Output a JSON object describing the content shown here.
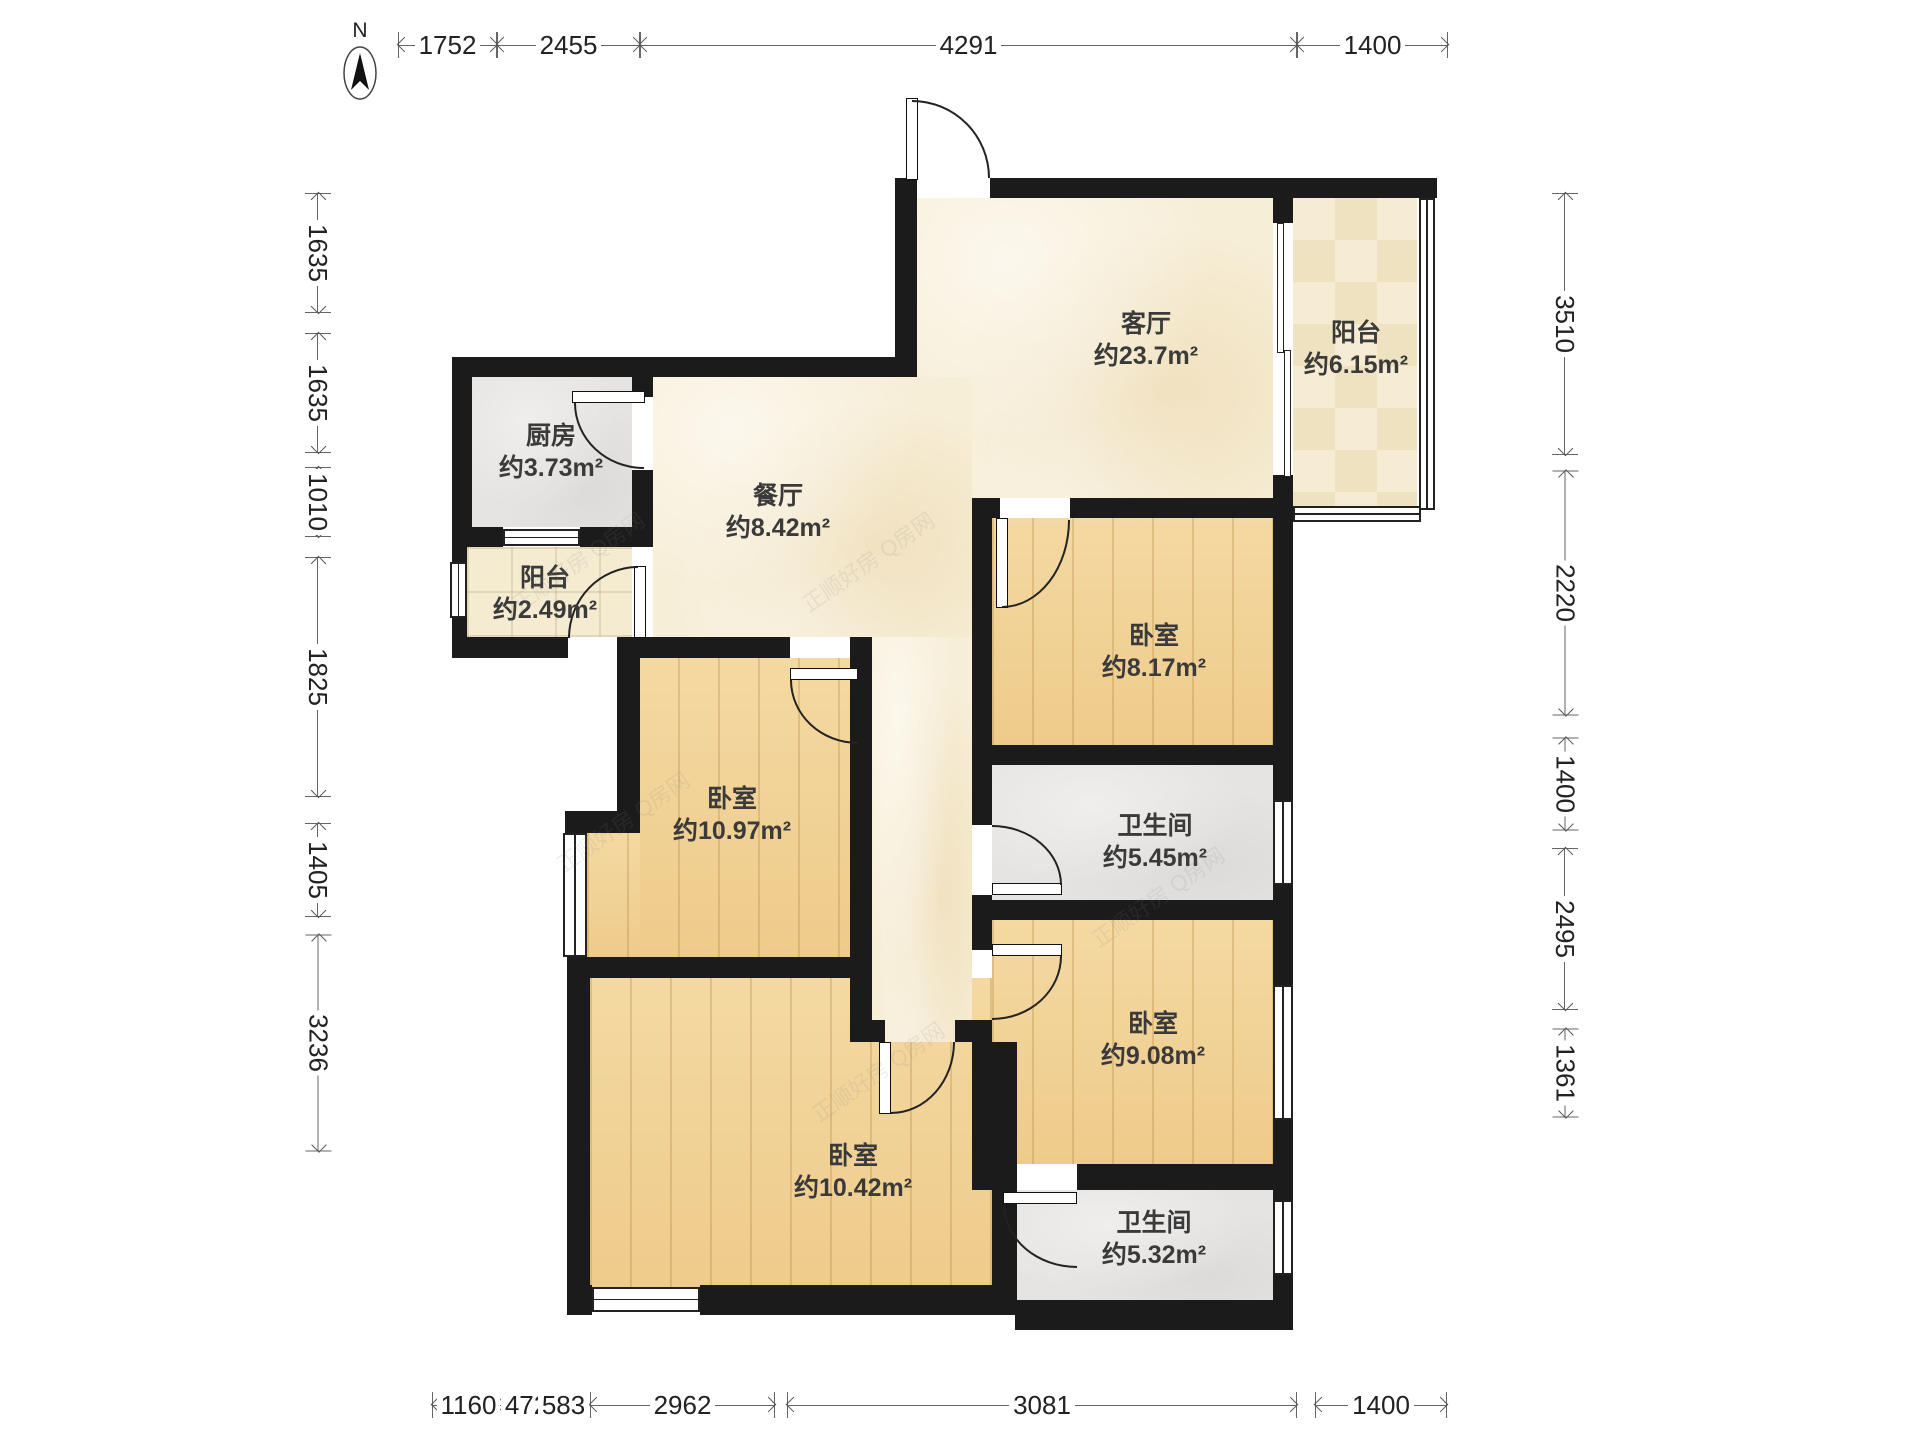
{
  "north": {
    "label": "N"
  },
  "watermark": {
    "text": "正顺好房 Q房网"
  },
  "rooms": [
    {
      "id": "living",
      "name": "客厅",
      "area": "约23.7m²"
    },
    {
      "id": "balcony-right",
      "name": "阳台",
      "area": "约6.15m²"
    },
    {
      "id": "kitchen",
      "name": "厨房",
      "area": "约3.73m²"
    },
    {
      "id": "dining",
      "name": "餐厅",
      "area": "约8.42m²"
    },
    {
      "id": "balcony-left",
      "name": "阳台",
      "area": "约2.49m²"
    },
    {
      "id": "bedroom-ne",
      "name": "卧室",
      "area": "约8.17m²"
    },
    {
      "id": "bedroom-west",
      "name": "卧室",
      "area": "约10.97m²"
    },
    {
      "id": "bathroom-mid",
      "name": "卫生间",
      "area": "约5.45m²"
    },
    {
      "id": "bedroom-east",
      "name": "卧室",
      "area": "约9.08m²"
    },
    {
      "id": "bedroom-south",
      "name": "卧室",
      "area": "约10.42m²"
    },
    {
      "id": "bathroom-south",
      "name": "卫生间",
      "area": "约5.32m²"
    }
  ],
  "dimensions": {
    "top": [
      {
        "value": "1752"
      },
      {
        "value": "2455"
      },
      {
        "value": "4291"
      },
      {
        "value": "1400"
      }
    ],
    "left": [
      {
        "value": "1635"
      },
      {
        "value": "1635"
      },
      {
        "value": "1010"
      },
      {
        "value": "1825"
      },
      {
        "value": "1405"
      },
      {
        "value": "3236"
      }
    ],
    "right": [
      {
        "value": "3510"
      },
      {
        "value": "2220"
      },
      {
        "value": "1400"
      },
      {
        "value": "2495"
      },
      {
        "value": "1361"
      }
    ],
    "bottom": [
      {
        "value": "1160"
      },
      {
        "value": "472"
      },
      {
        "value": "583"
      },
      {
        "value": "2962"
      },
      {
        "value": "3081"
      },
      {
        "value": "1400"
      }
    ]
  }
}
